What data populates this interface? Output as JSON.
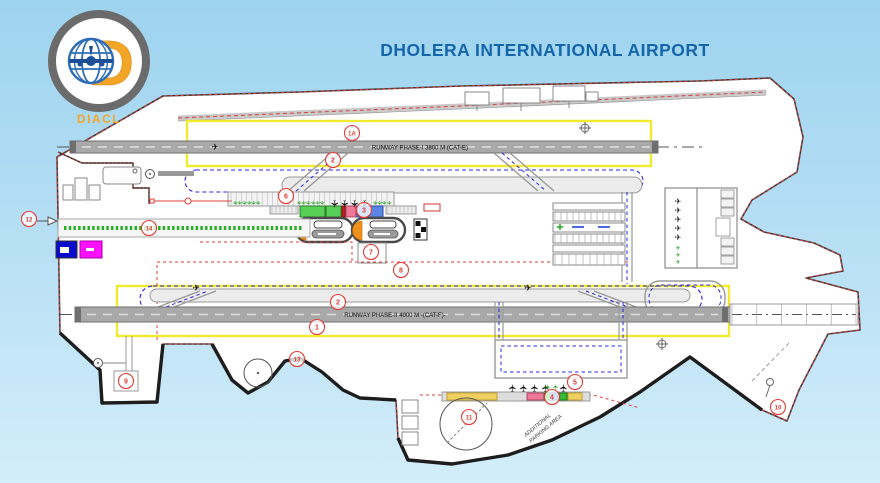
{
  "title": "DHOLERA INTERNATIONAL AIRPORT",
  "logo": {
    "abbr": "DIACL"
  },
  "colors": {
    "title_blue": "#1566a9",
    "logo_orange": "#f3a528",
    "callout_red": "#e23b34",
    "runway_box_yellow": "#f2ea2e",
    "taxiway_blue": "#2727e0",
    "apron_green": "#1f9e1f",
    "terminal_green": "#58d058",
    "terminal_pink": "#f07898",
    "terminal_blue": "#5b86e8",
    "marker_magenta": "#ff10ff",
    "marker_blue": "#0a0acc"
  },
  "plan": {
    "runway_top_label": "RUNWAY PHASE-I 3800 M (CAT-E)",
    "runway_bottom_label": "RUNWAY PHASE-II 4000 M -(CAT-F)-",
    "apron_note_line1": "ADDITIONAL",
    "apron_note_line2": "PARKING AREA",
    "icons": {
      "aircraft": "✈"
    },
    "callouts": [
      {
        "id": "1A",
        "x": 352,
        "y": 133
      },
      {
        "id": "2",
        "x": 333,
        "y": 160
      },
      {
        "id": "6",
        "x": 286,
        "y": 196
      },
      {
        "id": "3",
        "x": 364,
        "y": 210
      },
      {
        "id": "12",
        "x": 29,
        "y": 219
      },
      {
        "id": "14",
        "x": 149,
        "y": 228
      },
      {
        "id": "7",
        "x": 371,
        "y": 252
      },
      {
        "id": "8",
        "x": 401,
        "y": 270
      },
      {
        "id": "2",
        "x": 338,
        "y": 302
      },
      {
        "id": "1",
        "x": 317,
        "y": 327
      },
      {
        "id": "13",
        "x": 297,
        "y": 359
      },
      {
        "id": "9",
        "x": 126,
        "y": 381
      },
      {
        "id": "11",
        "x": 469,
        "y": 417
      },
      {
        "id": "4",
        "x": 552,
        "y": 397
      },
      {
        "id": "5",
        "x": 575,
        "y": 382
      },
      {
        "id": "10",
        "x": 778,
        "y": 407
      }
    ],
    "aircraft_rows": [
      {
        "name": "apron-top-green-1",
        "x": 233,
        "y": 203,
        "count": 6,
        "dx": 4.6,
        "color": "#1f9e1f",
        "size": 6,
        "rot": 90
      },
      {
        "name": "apron-top-green-2",
        "x": 297,
        "y": 203,
        "count": 6,
        "dx": 4.6,
        "color": "#1f9e1f",
        "size": 6,
        "rot": 90
      },
      {
        "name": "apron-top-black",
        "x": 331,
        "y": 204,
        "count": 4,
        "dx": 10,
        "color": "#161616",
        "size": 10,
        "rot": 90
      },
      {
        "name": "apron-top-green-3",
        "x": 373,
        "y": 203,
        "count": 4,
        "dx": 4.6,
        "color": "#1f9e1f",
        "size": 6,
        "rot": 90
      },
      {
        "name": "mro-black-column",
        "x": 678,
        "y": 204,
        "count": 5,
        "dx": 0,
        "dy": 9,
        "color": "#161616",
        "size": 8,
        "rot": 0
      },
      {
        "name": "mro-green-column",
        "x": 678,
        "y": 250,
        "count": 3,
        "dx": 0,
        "dy": 7,
        "color": "#1f9e1f",
        "size": 6,
        "rot": 0
      },
      {
        "name": "south-apron-black",
        "x": 516,
        "y": 388,
        "count": 4,
        "dx": 11,
        "color": "#161616",
        "size": 10,
        "rot": -90
      },
      {
        "name": "south-apron-green",
        "x": 550,
        "y": 387,
        "count": 2,
        "dx": 8,
        "color": "#1f9e1f",
        "size": 7,
        "rot": -90
      },
      {
        "name": "south-apron-black-2",
        "x": 567,
        "y": 388,
        "count": 1,
        "dx": 0,
        "color": "#161616",
        "size": 10,
        "rot": -90
      },
      {
        "name": "runway1-aircraft",
        "x": 215,
        "y": 150,
        "count": 1,
        "dx": 0,
        "color": "#161616",
        "size": 9,
        "rot": 0
      },
      {
        "name": "runway2-aircraft-left",
        "x": 196,
        "y": 291,
        "count": 1,
        "dx": 0,
        "color": "#161616",
        "size": 9,
        "rot": 0
      },
      {
        "name": "runway2-aircraft-mid",
        "x": 528,
        "y": 291,
        "count": 1,
        "dx": 0,
        "color": "#161616",
        "size": 9,
        "rot": 0
      }
    ]
  }
}
